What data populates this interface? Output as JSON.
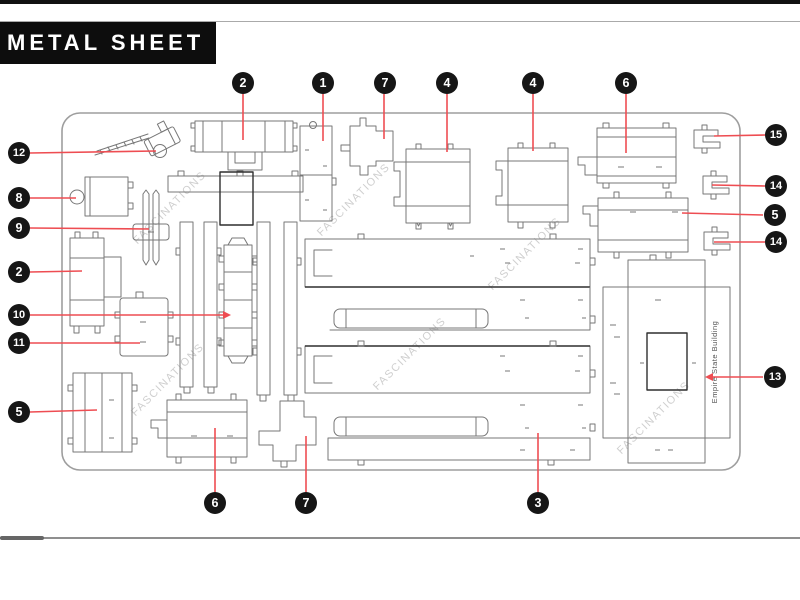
{
  "header": {
    "title": "METAL SHEET"
  },
  "sheet": {
    "part13_label": "Empire State Building"
  },
  "watermark": {
    "text": "FASCINATIONS",
    "positions": [
      [
        172,
        210
      ],
      [
        356,
        202
      ],
      [
        527,
        256
      ],
      [
        170,
        382
      ],
      [
        412,
        356
      ],
      [
        656,
        420
      ]
    ]
  },
  "callouts": [
    {
      "number": "12",
      "cx": 19,
      "cy": 153,
      "line": [
        30,
        153,
        156,
        151
      ]
    },
    {
      "number": "8",
      "cx": 19,
      "cy": 198,
      "line": [
        30,
        198,
        76,
        198
      ]
    },
    {
      "number": "9",
      "cx": 19,
      "cy": 228,
      "line": [
        30,
        228,
        149,
        229
      ]
    },
    {
      "number": "2",
      "cx": 19,
      "cy": 272,
      "line": [
        30,
        272,
        82,
        271
      ]
    },
    {
      "number": "10",
      "cx": 19,
      "cy": 315,
      "line": [
        30,
        315,
        224,
        315
      ],
      "arrow": "end"
    },
    {
      "number": "11",
      "cx": 19,
      "cy": 343,
      "line": [
        30,
        343,
        140,
        343
      ]
    },
    {
      "number": "5",
      "cx": 19,
      "cy": 412,
      "line": [
        30,
        412,
        97,
        410
      ]
    },
    {
      "number": "2",
      "cx": 243,
      "cy": 83,
      "line": [
        243,
        94,
        243,
        140
      ]
    },
    {
      "number": "1",
      "cx": 323,
      "cy": 83,
      "line": [
        323,
        94,
        323,
        141
      ]
    },
    {
      "number": "7",
      "cx": 385,
      "cy": 83,
      "line": [
        384,
        94,
        384,
        139
      ]
    },
    {
      "number": "4",
      "cx": 447,
      "cy": 83,
      "line": [
        447,
        94,
        447,
        152
      ]
    },
    {
      "number": "4",
      "cx": 533,
      "cy": 83,
      "line": [
        533,
        94,
        533,
        151
      ]
    },
    {
      "number": "6",
      "cx": 626,
      "cy": 83,
      "line": [
        626,
        94,
        626,
        153
      ]
    },
    {
      "number": "15",
      "cx": 776,
      "cy": 135,
      "line": [
        714,
        136,
        765,
        135
      ]
    },
    {
      "number": "14",
      "cx": 776,
      "cy": 186,
      "line": [
        712,
        185,
        765,
        186
      ]
    },
    {
      "number": "5",
      "cx": 775,
      "cy": 215,
      "line": [
        682,
        213,
        763,
        215
      ]
    },
    {
      "number": "14",
      "cx": 776,
      "cy": 242,
      "line": [
        714,
        242,
        765,
        242
      ]
    },
    {
      "number": "13",
      "cx": 775,
      "cy": 377,
      "line": [
        712,
        377,
        763,
        377
      ],
      "arrow": "start"
    },
    {
      "number": "6",
      "cx": 215,
      "cy": 503,
      "line": [
        215,
        428,
        215,
        492
      ]
    },
    {
      "number": "7",
      "cx": 306,
      "cy": 503,
      "line": [
        306,
        436,
        306,
        492
      ]
    },
    {
      "number": "3",
      "cx": 538,
      "cy": 503,
      "line": [
        538,
        433,
        538,
        492
      ]
    }
  ],
  "colors": {
    "accent_red": "#ee4d52",
    "badge_black": "#161616",
    "badge_text": "#ffffff",
    "outline_gray": "#777777",
    "outline_dark": "#2f2f2f",
    "sheet_gray": "#9e9e9e",
    "watermark_gray": "#cfcfcf",
    "banner_black": "#0d0d0d"
  }
}
